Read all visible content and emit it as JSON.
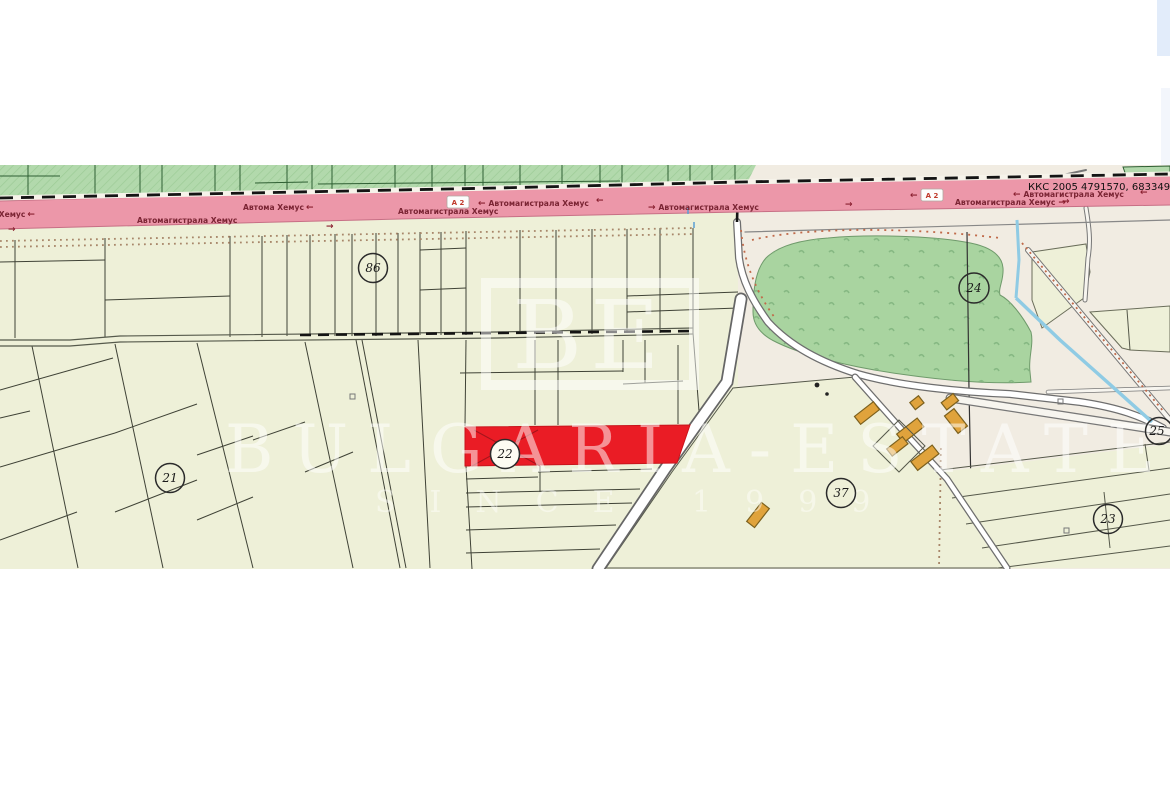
{
  "page": {
    "background": "#ffffff"
  },
  "map": {
    "reference_text": "ККС 2005 4791570, 683349",
    "highway": {
      "name": "Автомагистрала Хемус",
      "short_name": "Автома Хемус",
      "route_badge": "А 2",
      "arrow_left": "←",
      "arrow_right": "→"
    },
    "parcel_labels": {
      "p86": "86",
      "p21": "21",
      "p22": "22",
      "p24": "24",
      "p25": "25",
      "p37": "37",
      "p23": "23"
    },
    "highlighted_parcel": "22",
    "watermark": {
      "brand": "BULGARIA-ESTATE",
      "tagline": "SINCE 1999",
      "logo_initials": "BE"
    },
    "colors": {
      "highlight_red": "#ea1c25",
      "highway_pink": "#ec97a9",
      "field_cream": "#eef0d8",
      "urban_beige": "#f1ece2",
      "green_parcel": "#b2d9ac",
      "forest_green": "#a9d4a0",
      "stream_blue": "#8fcbe4",
      "building_orange": "#e0a33c",
      "boundary_dark": "#1a1a1a"
    }
  }
}
